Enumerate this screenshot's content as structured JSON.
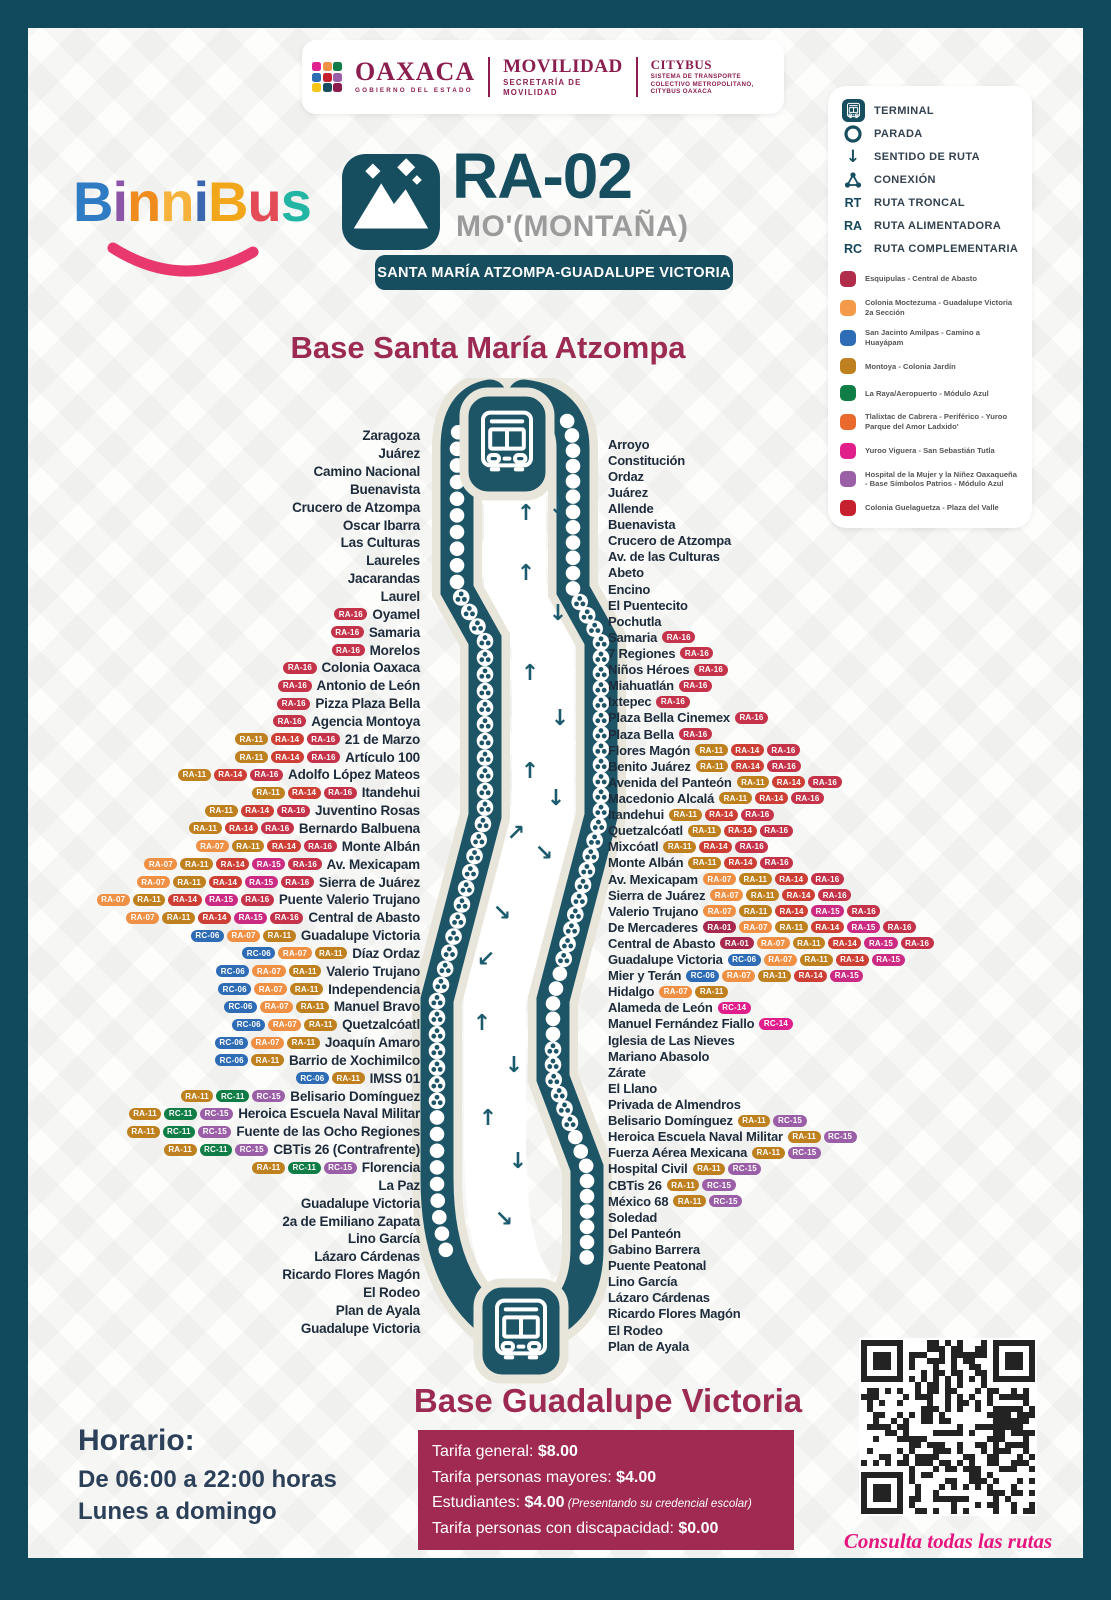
{
  "header": {
    "gov": {
      "name": "OAXACA",
      "sub": "GOBIERNO DEL ESTADO"
    },
    "movilidad": {
      "name": "MOVILIDAD",
      "sub": "SECRETARÍA DE MOVILIDAD"
    },
    "citybus": {
      "name": "CITYBUS",
      "sub": "SISTEMA DE TRANSPORTE COLECTIVO METROPOLITANO, CITYBUS OAXACA"
    },
    "emblem_colors": [
      "#e0218f",
      "#f09045",
      "#0f7d45",
      "#2e6cb5",
      "#c4202e",
      "#9b5fa8",
      "#f5c518",
      "#164e60",
      "#8c1d4f"
    ]
  },
  "logo": {
    "letters": [
      {
        "ch": "B",
        "color": "#2f7cc4"
      },
      {
        "ch": "i",
        "color": "#8d55a8"
      },
      {
        "ch": "n",
        "color": "#f08c1e"
      },
      {
        "ch": "n",
        "color": "#f6b23a"
      },
      {
        "ch": "i",
        "color": "#3b66b0"
      },
      {
        "ch": "B",
        "color": "#f2a71b"
      },
      {
        "ch": "u",
        "color": "#e34b57"
      },
      {
        "ch": "s",
        "color": "#23b5a3"
      }
    ],
    "smile_color": "#e8386d"
  },
  "route": {
    "code": "RA-02",
    "name": "MO'(MONTAÑA)",
    "subtitle": "SANTA MARÍA ATZOMPA-GUADALUPE VICTORIA",
    "icon": "mountain-icon"
  },
  "legend": {
    "symbols": [
      {
        "icon": "terminal-icon",
        "label": "TERMINAL"
      },
      {
        "icon": "stop-icon",
        "label": "PARADA"
      },
      {
        "icon": "route-direction-icon",
        "label": "SENTIDO DE RUTA"
      },
      {
        "icon": "connection-icon",
        "label": "CONEXIÓN"
      },
      {
        "abbr": "RT",
        "label": "RUTA TRONCAL"
      },
      {
        "abbr": "RA",
        "label": "RUTA ALIMENTADORA"
      },
      {
        "abbr": "RC",
        "label": "RUTA COMPLEMENTARIA"
      }
    ],
    "connections": [
      {
        "color": "#b02d4c",
        "label": "Esquipulas - Central de Abasto"
      },
      {
        "color": "#f59a4b",
        "label": "Colonia Moctezuma - Guadalupe Victoria 2a Sección"
      },
      {
        "color": "#2e6cb5",
        "label": "San Jacinto Amilpas - Camino a Huayápam"
      },
      {
        "color": "#bf811f",
        "label": "Montoya - Colonia Jardín"
      },
      {
        "color": "#0f7d45",
        "label": "La Raya/Aeropuerto - Módulo Azul"
      },
      {
        "color": "#ea6a2e",
        "label": "Tlalixtac de Cabrera - Periférico - Yuroo Parque del Amor Ladxido'"
      },
      {
        "color": "#e01e8c",
        "label": "Yuroo Viguera - San Sebastián Tutla"
      },
      {
        "color": "#9b5fa8",
        "label": "Hospital de la Mujer y la Niñez Oaxaqueña - Base Símbolos Patrios - Módulo Azul"
      },
      {
        "color": "#c4202e",
        "label": "Colonia Guelaguetza - Plaza del Valle"
      }
    ]
  },
  "base_top_title": "Base Santa María Atzompa",
  "base_bottom_title": "Base Guadalupe Victoria",
  "badge_colors": {
    "RA-01": "#a8294d",
    "RA-07": "#f09045",
    "RA-11": "#bf811f",
    "RA-14": "#cd3f35",
    "RA-15": "#cb2b82",
    "RA-16": "#c43349",
    "RC-06": "#2e6cb5",
    "RC-11": "#0f7d45",
    "RC-14": "#e01e8c",
    "RC-15": "#9b5fa8"
  },
  "stops_left": [
    {
      "name": "Zaragoza",
      "badges": []
    },
    {
      "name": "Juárez",
      "badges": []
    },
    {
      "name": "Camino Nacional",
      "badges": []
    },
    {
      "name": "Buenavista",
      "badges": []
    },
    {
      "name": "Crucero de Atzompa",
      "badges": []
    },
    {
      "name": "Oscar Ibarra",
      "badges": []
    },
    {
      "name": "Las Culturas",
      "badges": []
    },
    {
      "name": "Laureles",
      "badges": []
    },
    {
      "name": "Jacarandas",
      "badges": []
    },
    {
      "name": "Laurel",
      "badges": []
    },
    {
      "name": "Oyamel",
      "badges": [
        "RA-16"
      ]
    },
    {
      "name": "Samaria",
      "badges": [
        "RA-16"
      ]
    },
    {
      "name": "Morelos",
      "badges": [
        "RA-16"
      ]
    },
    {
      "name": "Colonia Oaxaca",
      "badges": [
        "RA-16"
      ]
    },
    {
      "name": "Antonio de León",
      "badges": [
        "RA-16"
      ]
    },
    {
      "name": "Pizza Plaza Bella",
      "badges": [
        "RA-16"
      ]
    },
    {
      "name": "Agencia Montoya",
      "badges": [
        "RA-16"
      ]
    },
    {
      "name": "21 de Marzo",
      "badges": [
        "RA-11",
        "RA-14",
        "RA-16"
      ]
    },
    {
      "name": "Artículo 100",
      "badges": [
        "RA-11",
        "RA-14",
        "RA-16"
      ]
    },
    {
      "name": "Adolfo López Mateos",
      "badges": [
        "RA-11",
        "RA-14",
        "RA-16"
      ]
    },
    {
      "name": "Itandehui",
      "badges": [
        "RA-11",
        "RA-14",
        "RA-16"
      ]
    },
    {
      "name": "Juventino Rosas",
      "badges": [
        "RA-11",
        "RA-14",
        "RA-16"
      ]
    },
    {
      "name": "Bernardo Balbuena",
      "badges": [
        "RA-11",
        "RA-14",
        "RA-16"
      ]
    },
    {
      "name": "Monte Albán",
      "badges": [
        "RA-07",
        "RA-11",
        "RA-14",
        "RA-16"
      ]
    },
    {
      "name": "Av. Mexicapam",
      "badges": [
        "RA-07",
        "RA-11",
        "RA-14",
        "RA-15",
        "RA-16"
      ]
    },
    {
      "name": "Sierra de Juárez",
      "badges": [
        "RA-07",
        "RA-11",
        "RA-14",
        "RA-15",
        "RA-16"
      ]
    },
    {
      "name": "Puente Valerio Trujano",
      "badges": [
        "RA-07",
        "RA-11",
        "RA-14",
        "RA-15",
        "RA-16"
      ]
    },
    {
      "name": "Central de Abasto",
      "badges": [
        "RA-07",
        "RA-11",
        "RA-14",
        "RA-15",
        "RA-16"
      ]
    },
    {
      "name": "Guadalupe Victoria",
      "badges": [
        "RC-06",
        "RA-07",
        "RA-11"
      ]
    },
    {
      "name": "Díaz Ordaz",
      "badges": [
        "RC-06",
        "RA-07",
        "RA-11"
      ]
    },
    {
      "name": "Valerio Trujano",
      "badges": [
        "RC-06",
        "RA-07",
        "RA-11"
      ]
    },
    {
      "name": "Independencia",
      "badges": [
        "RC-06",
        "RA-07",
        "RA-11"
      ]
    },
    {
      "name": "Manuel Bravo",
      "badges": [
        "RC-06",
        "RA-07",
        "RA-11"
      ]
    },
    {
      "name": "Quetzalcóatl",
      "badges": [
        "RC-06",
        "RA-07",
        "RA-11"
      ]
    },
    {
      "name": "Joaquín Amaro",
      "badges": [
        "RC-06",
        "RA-07",
        "RA-11"
      ]
    },
    {
      "name": "Barrio de Xochimilco",
      "badges": [
        "RC-06",
        "RA-11"
      ]
    },
    {
      "name": "IMSS 01",
      "badges": [
        "RC-06",
        "RA-11"
      ]
    },
    {
      "name": "Belisario Domínguez",
      "badges": [
        "RA-11",
        "RC-11",
        "RC-15"
      ]
    },
    {
      "name": "Heroica Escuela Naval Militar",
      "badges": [
        "RA-11",
        "RC-11",
        "RC-15"
      ]
    },
    {
      "name": "Fuente de las Ocho Regiones",
      "badges": [
        "RA-11",
        "RC-11",
        "RC-15"
      ]
    },
    {
      "name": "CBTis 26 (Contrafrente)",
      "badges": [
        "RA-11",
        "RC-11",
        "RC-15"
      ]
    },
    {
      "name": "Florencia",
      "badges": [
        "RA-11",
        "RC-11",
        "RC-15"
      ]
    },
    {
      "name": "La Paz",
      "badges": []
    },
    {
      "name": "Guadalupe Victoria",
      "badges": []
    },
    {
      "name": "2a de Emiliano Zapata",
      "badges": []
    },
    {
      "name": "Lino García",
      "badges": []
    },
    {
      "name": "Lázaro Cárdenas",
      "badges": []
    },
    {
      "name": "Ricardo Flores Magón",
      "badges": []
    },
    {
      "name": "El Rodeo",
      "badges": []
    },
    {
      "name": "Plan de Ayala",
      "badges": []
    },
    {
      "name": "Guadalupe Victoria",
      "badges": []
    }
  ],
  "stops_right": [
    {
      "name": "Arroyo",
      "badges": []
    },
    {
      "name": "Constitución",
      "badges": []
    },
    {
      "name": "Ordaz",
      "badges": []
    },
    {
      "name": "Juárez",
      "badges": []
    },
    {
      "name": "Allende",
      "badges": []
    },
    {
      "name": "Buenavista",
      "badges": []
    },
    {
      "name": "Crucero de Atzompa",
      "badges": []
    },
    {
      "name": "Av. de las Culturas",
      "badges": []
    },
    {
      "name": "Abeto",
      "badges": []
    },
    {
      "name": "Encino",
      "badges": []
    },
    {
      "name": "El Puentecito",
      "badges": []
    },
    {
      "name": "Pochutla",
      "badges": []
    },
    {
      "name": "Samaria",
      "badges": [
        "RA-16"
      ]
    },
    {
      "name": "7 Regiones",
      "badges": [
        "RA-16"
      ]
    },
    {
      "name": "Niños Héroes",
      "badges": [
        "RA-16"
      ]
    },
    {
      "name": "Miahuatlán",
      "badges": [
        "RA-16"
      ]
    },
    {
      "name": "Ixtepec",
      "badges": [
        "RA-16"
      ]
    },
    {
      "name": "Plaza Bella Cinemex",
      "badges": [
        "RA-16"
      ]
    },
    {
      "name": "Plaza Bella",
      "badges": [
        "RA-16"
      ]
    },
    {
      "name": "Flores Magón",
      "badges": [
        "RA-11",
        "RA-14",
        "RA-16"
      ]
    },
    {
      "name": "Benito Juárez",
      "badges": [
        "RA-11",
        "RA-14",
        "RA-16"
      ]
    },
    {
      "name": "Avenida del Panteón",
      "badges": [
        "RA-11",
        "RA-14",
        "RA-16"
      ]
    },
    {
      "name": "Macedonio Alcalá",
      "badges": [
        "RA-11",
        "RA-14",
        "RA-16"
      ]
    },
    {
      "name": "Itandehui",
      "badges": [
        "RA-11",
        "RA-14",
        "RA-16"
      ]
    },
    {
      "name": "Quetzalcóatl",
      "badges": [
        "RA-11",
        "RA-14",
        "RA-16"
      ]
    },
    {
      "name": "Mixcóatl",
      "badges": [
        "RA-11",
        "RA-14",
        "RA-16"
      ]
    },
    {
      "name": "Monte Albán",
      "badges": [
        "RA-11",
        "RA-14",
        "RA-16"
      ]
    },
    {
      "name": "Av. Mexicapam",
      "badges": [
        "RA-07",
        "RA-11",
        "RA-14",
        "RA-16"
      ]
    },
    {
      "name": "Sierra de Juárez",
      "badges": [
        "RA-07",
        "RA-11",
        "RA-14",
        "RA-16"
      ]
    },
    {
      "name": "Valerio Trujano",
      "badges": [
        "RA-07",
        "RA-11",
        "RA-14",
        "RA-15",
        "RA-16"
      ]
    },
    {
      "name": "De Mercaderes",
      "badges": [
        "RA-01",
        "RA-07",
        "RA-11",
        "RA-14",
        "RA-15",
        "RA-16"
      ]
    },
    {
      "name": "Central de Abasto",
      "badges": [
        "RA-01",
        "RA-07",
        "RA-11",
        "RA-14",
        "RA-15",
        "RA-16"
      ]
    },
    {
      "name": "Guadalupe Victoria",
      "badges": [
        "RC-06",
        "RA-07",
        "RA-11",
        "RA-14",
        "RA-15"
      ]
    },
    {
      "name": "Mier y Terán",
      "badges": [
        "RC-06",
        "RA-07",
        "RA-11",
        "RA-14",
        "RA-15"
      ]
    },
    {
      "name": "Hidalgo",
      "badges": [
        "RA-07",
        "RA-11"
      ]
    },
    {
      "name": "Alameda de León",
      "badges": [
        "RC-14"
      ]
    },
    {
      "name": "Manuel Fernández Fiallo",
      "badges": [
        "RC-14"
      ]
    },
    {
      "name": "Iglesia de Las Nieves",
      "badges": []
    },
    {
      "name": "Mariano Abasolo",
      "badges": []
    },
    {
      "name": "Zárate",
      "badges": []
    },
    {
      "name": "El Llano",
      "badges": []
    },
    {
      "name": "Privada de Almendros",
      "badges": []
    },
    {
      "name": "Belisario Domínguez",
      "badges": [
        "RA-11",
        "RC-15"
      ]
    },
    {
      "name": "Heroica Escuela Naval Militar",
      "badges": [
        "RA-11",
        "RC-15"
      ]
    },
    {
      "name": "Fuerza Aérea Mexicana",
      "badges": [
        "RA-11",
        "RC-15"
      ]
    },
    {
      "name": "Hospital Civil",
      "badges": [
        "RA-11",
        "RC-15"
      ]
    },
    {
      "name": "CBTis 26",
      "badges": [
        "RA-11",
        "RC-15"
      ]
    },
    {
      "name": "México 68",
      "badges": [
        "RA-11",
        "RC-15"
      ]
    },
    {
      "name": "Soledad",
      "badges": []
    },
    {
      "name": "Del Panteón",
      "badges": []
    },
    {
      "name": "Gabino Barrera",
      "badges": []
    },
    {
      "name": "Puente Peatonal",
      "badges": []
    },
    {
      "name": "Lino García",
      "badges": []
    },
    {
      "name": "Lázaro Cárdenas",
      "badges": []
    },
    {
      "name": "Ricardo Flores Magón",
      "badges": []
    },
    {
      "name": "El Rodeo",
      "badges": []
    },
    {
      "name": "Plan de Ayala",
      "badges": []
    }
  ],
  "schedule": {
    "title": "Horario:",
    "line1_prefix": "De ",
    "line1_bold": "06:00 a 22:00",
    "line1_suffix": " horas",
    "line2": "Lunes a domingo"
  },
  "fares": [
    {
      "label": "Tarifa general: ",
      "amount": "$8.00",
      "note": ""
    },
    {
      "label": "Tarifa personas mayores: ",
      "amount": "$4.00",
      "note": ""
    },
    {
      "label": "Estudiantes: ",
      "amount": "$4.00",
      "note": " (Presentando su credencial escolar)"
    },
    {
      "label": "Tarifa personas con discapacidad: ",
      "amount": "$0.00",
      "note": ""
    }
  ],
  "qr_caption": "Consulta todas las rutas",
  "colors": {
    "teal": "#164e60",
    "band": "#1d5567",
    "beige": "#e8e5da",
    "maroon": "#9c2a52"
  }
}
